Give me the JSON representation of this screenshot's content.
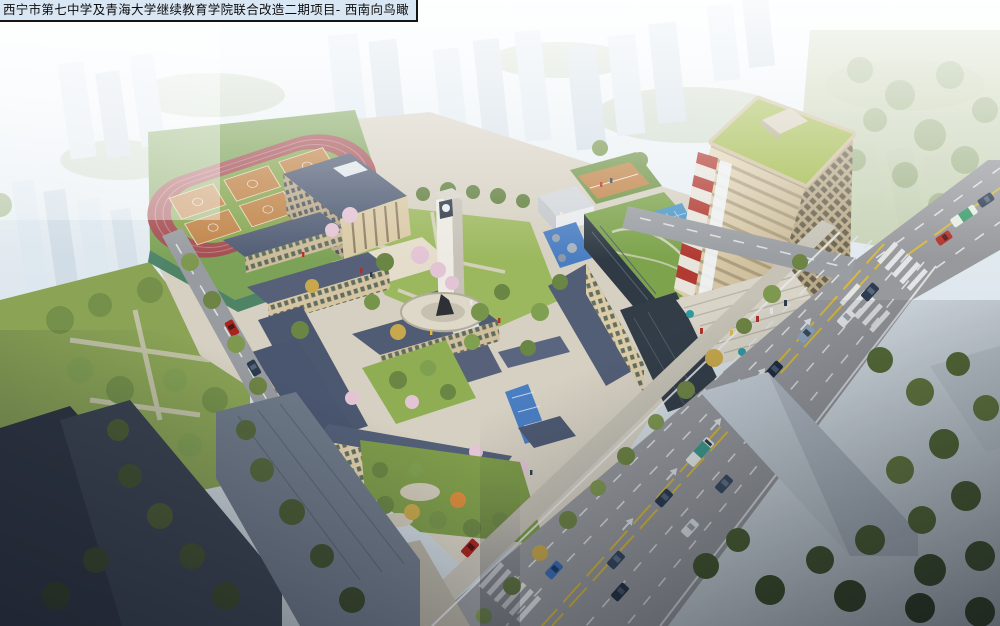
{
  "header": {
    "title": "西宁市第七中学及青海大学继续教育学院联合改造二期项目- 西南向鸟瞰"
  },
  "scene": {
    "kind": "aerial-architectural-rendering",
    "palette": {
      "haze": "#f2f7fa",
      "context_building": "#dde7ef",
      "track_red": "#a34e52",
      "field_green": "#86a650",
      "court_orange": "#c08448",
      "lawn_green": "#9cb85e",
      "roof_slate": "#505c74",
      "facade_beige": "#d9c9a5",
      "tower_roof_green": "#a3bb4d",
      "tower_facade": "#d3c4a2",
      "stripe_red": "#b13a32",
      "road_asphalt": "#97999d",
      "lane_yellow": "#d7b93e",
      "marking_white": "#e8eaec",
      "water_blue": "#4a7ec2",
      "tree_green": "#7a9048",
      "dark_roof": "#2e3542"
    }
  }
}
